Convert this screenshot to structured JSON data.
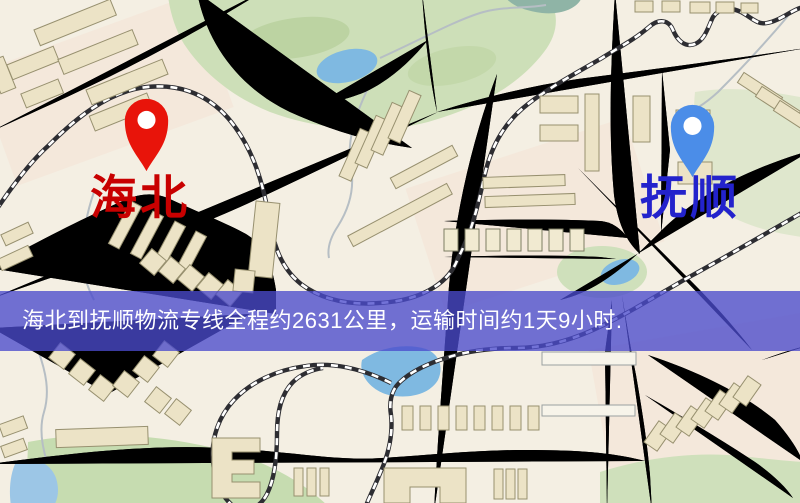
{
  "map": {
    "origin": {
      "name": "海北",
      "label_color": "#c80000",
      "pin_color": "#e8140a",
      "pin_inner": "#ffffff"
    },
    "destination": {
      "name": "抚顺",
      "label_color": "#2323cc",
      "pin_color": "#4b8de8",
      "pin_inner": "#ffffff"
    },
    "banner": {
      "text": "海北到抚顺物流专线全程约2631公里，运输时间约1天9小时.",
      "background": "#4a4acc",
      "text_color": "#ffffff"
    },
    "map_colors": {
      "background": "#f4efe3",
      "road": "#f6d677",
      "road_casing": "#e2b958",
      "park": "#cddfb8",
      "water": "#7fb9e1",
      "railway": "#2d2d32",
      "building": "#ece3c6"
    }
  }
}
